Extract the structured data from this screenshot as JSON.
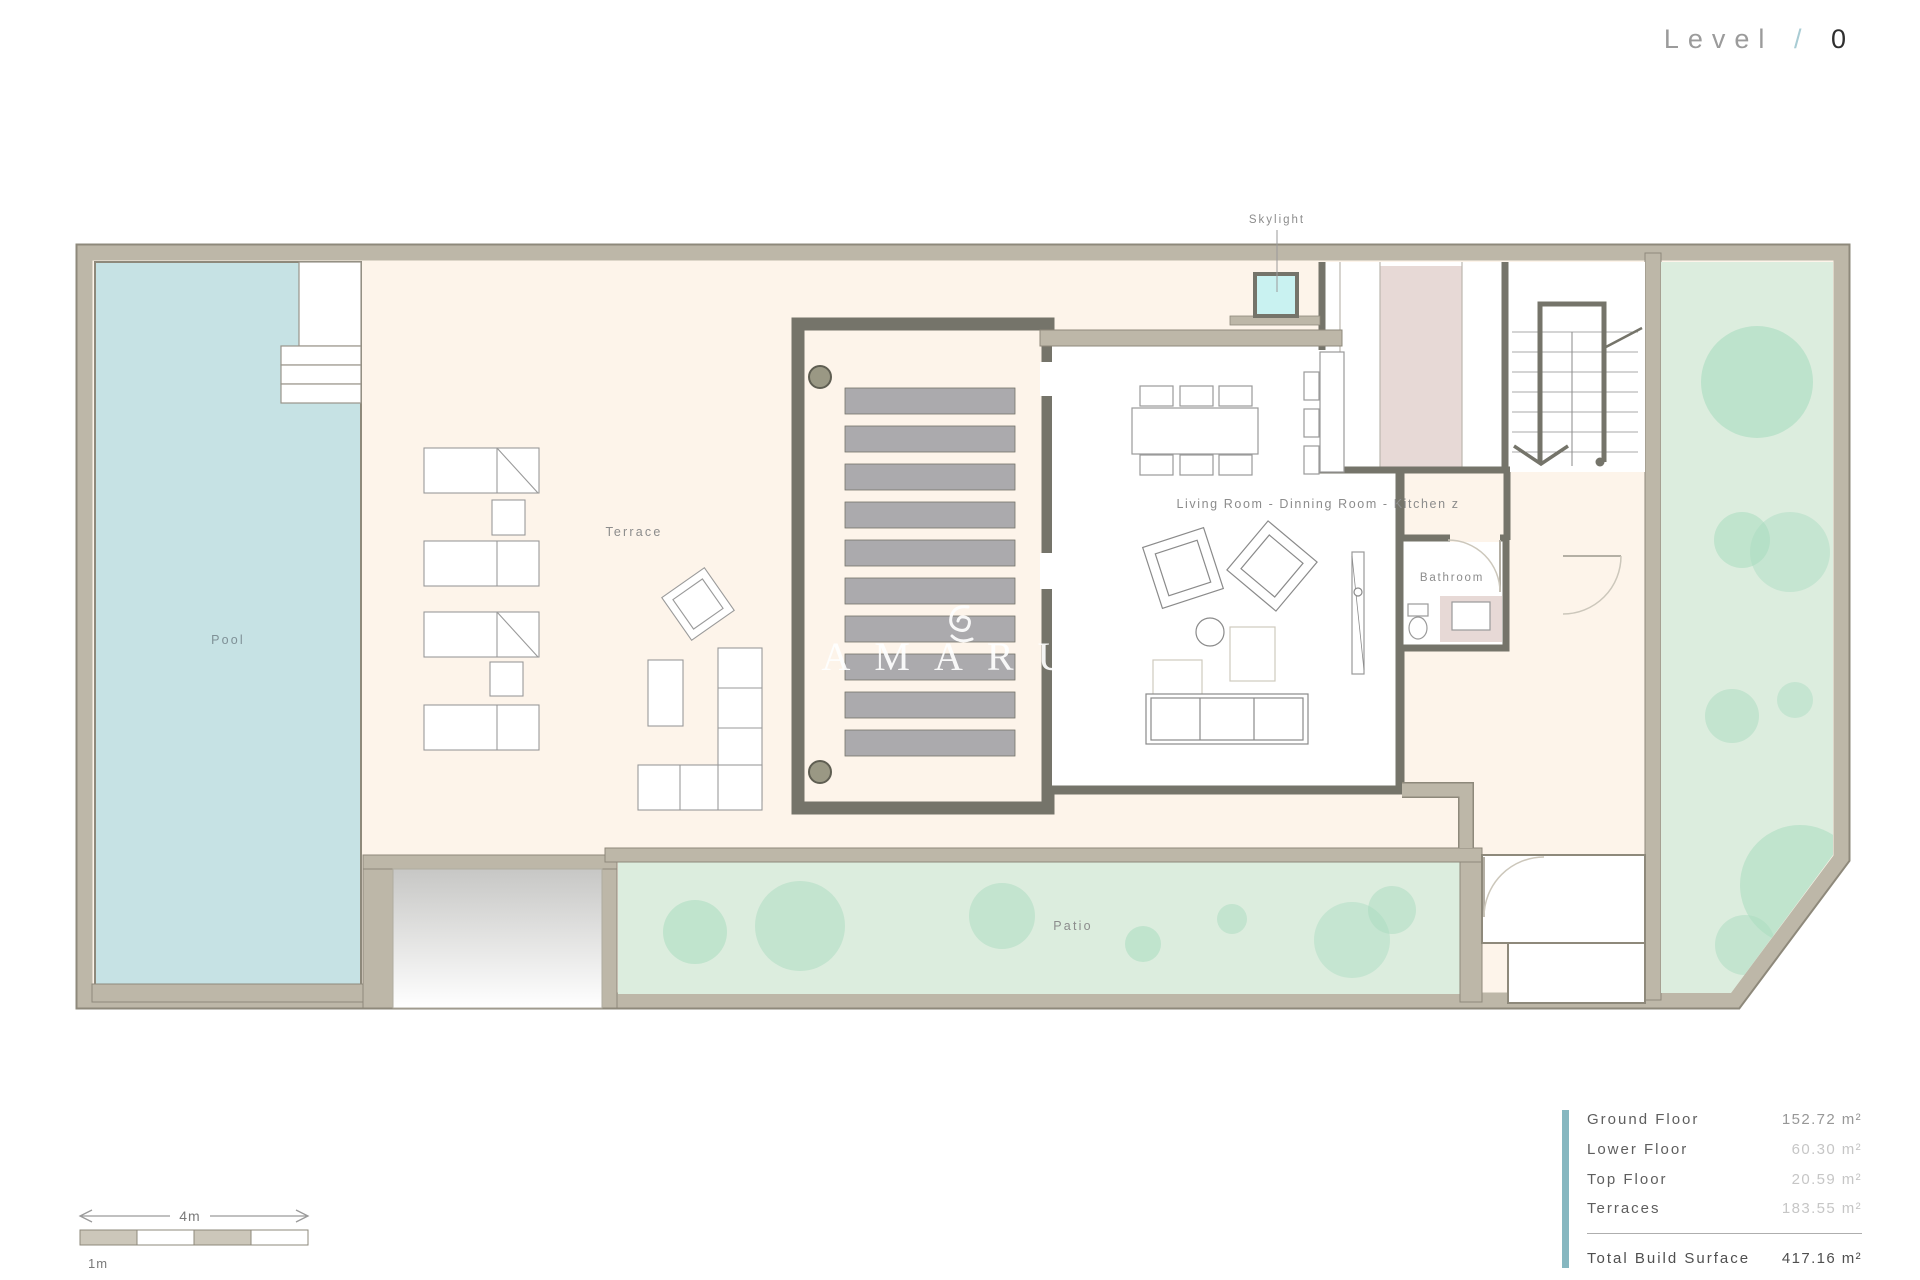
{
  "header": {
    "level_label": "Level",
    "separator": "/",
    "level_value": "0"
  },
  "labels": {
    "pool": "Pool",
    "terrace": "Terrace",
    "living_room": "Living Room - Dinning Room - Kitchen z",
    "bathroom": "Bathroom",
    "patio": "Patio",
    "skylight": "Skylight"
  },
  "watermark": {
    "name": "AMARU"
  },
  "area_table": {
    "rows": [
      {
        "label": "Ground Floor",
        "value": "152.72 m²"
      },
      {
        "label": "Lower Floor",
        "value": "60.30 m²"
      },
      {
        "label": "Top Floor",
        "value": "20.59 m²"
      },
      {
        "label": "Terraces",
        "value": "183.55 m²"
      }
    ],
    "total_label": "Total Build Surface",
    "total_value": "417.16 m²"
  },
  "scale": {
    "major": "4m",
    "minor": "1m"
  },
  "colors": {
    "accent_teal": "#86b7c0",
    "pool_blue": "#c6e2e4",
    "garden_green": "#dcedde",
    "tree_green": "#a9dcc0",
    "skylight_cyan": "#c9f2f1",
    "wall_beige": "#bdb7a8",
    "wall_dark": "#75746a",
    "floor_cream": "#fdf4ea",
    "slat_gray": "#abaaad",
    "slash_blue": "#a9ccd4"
  }
}
